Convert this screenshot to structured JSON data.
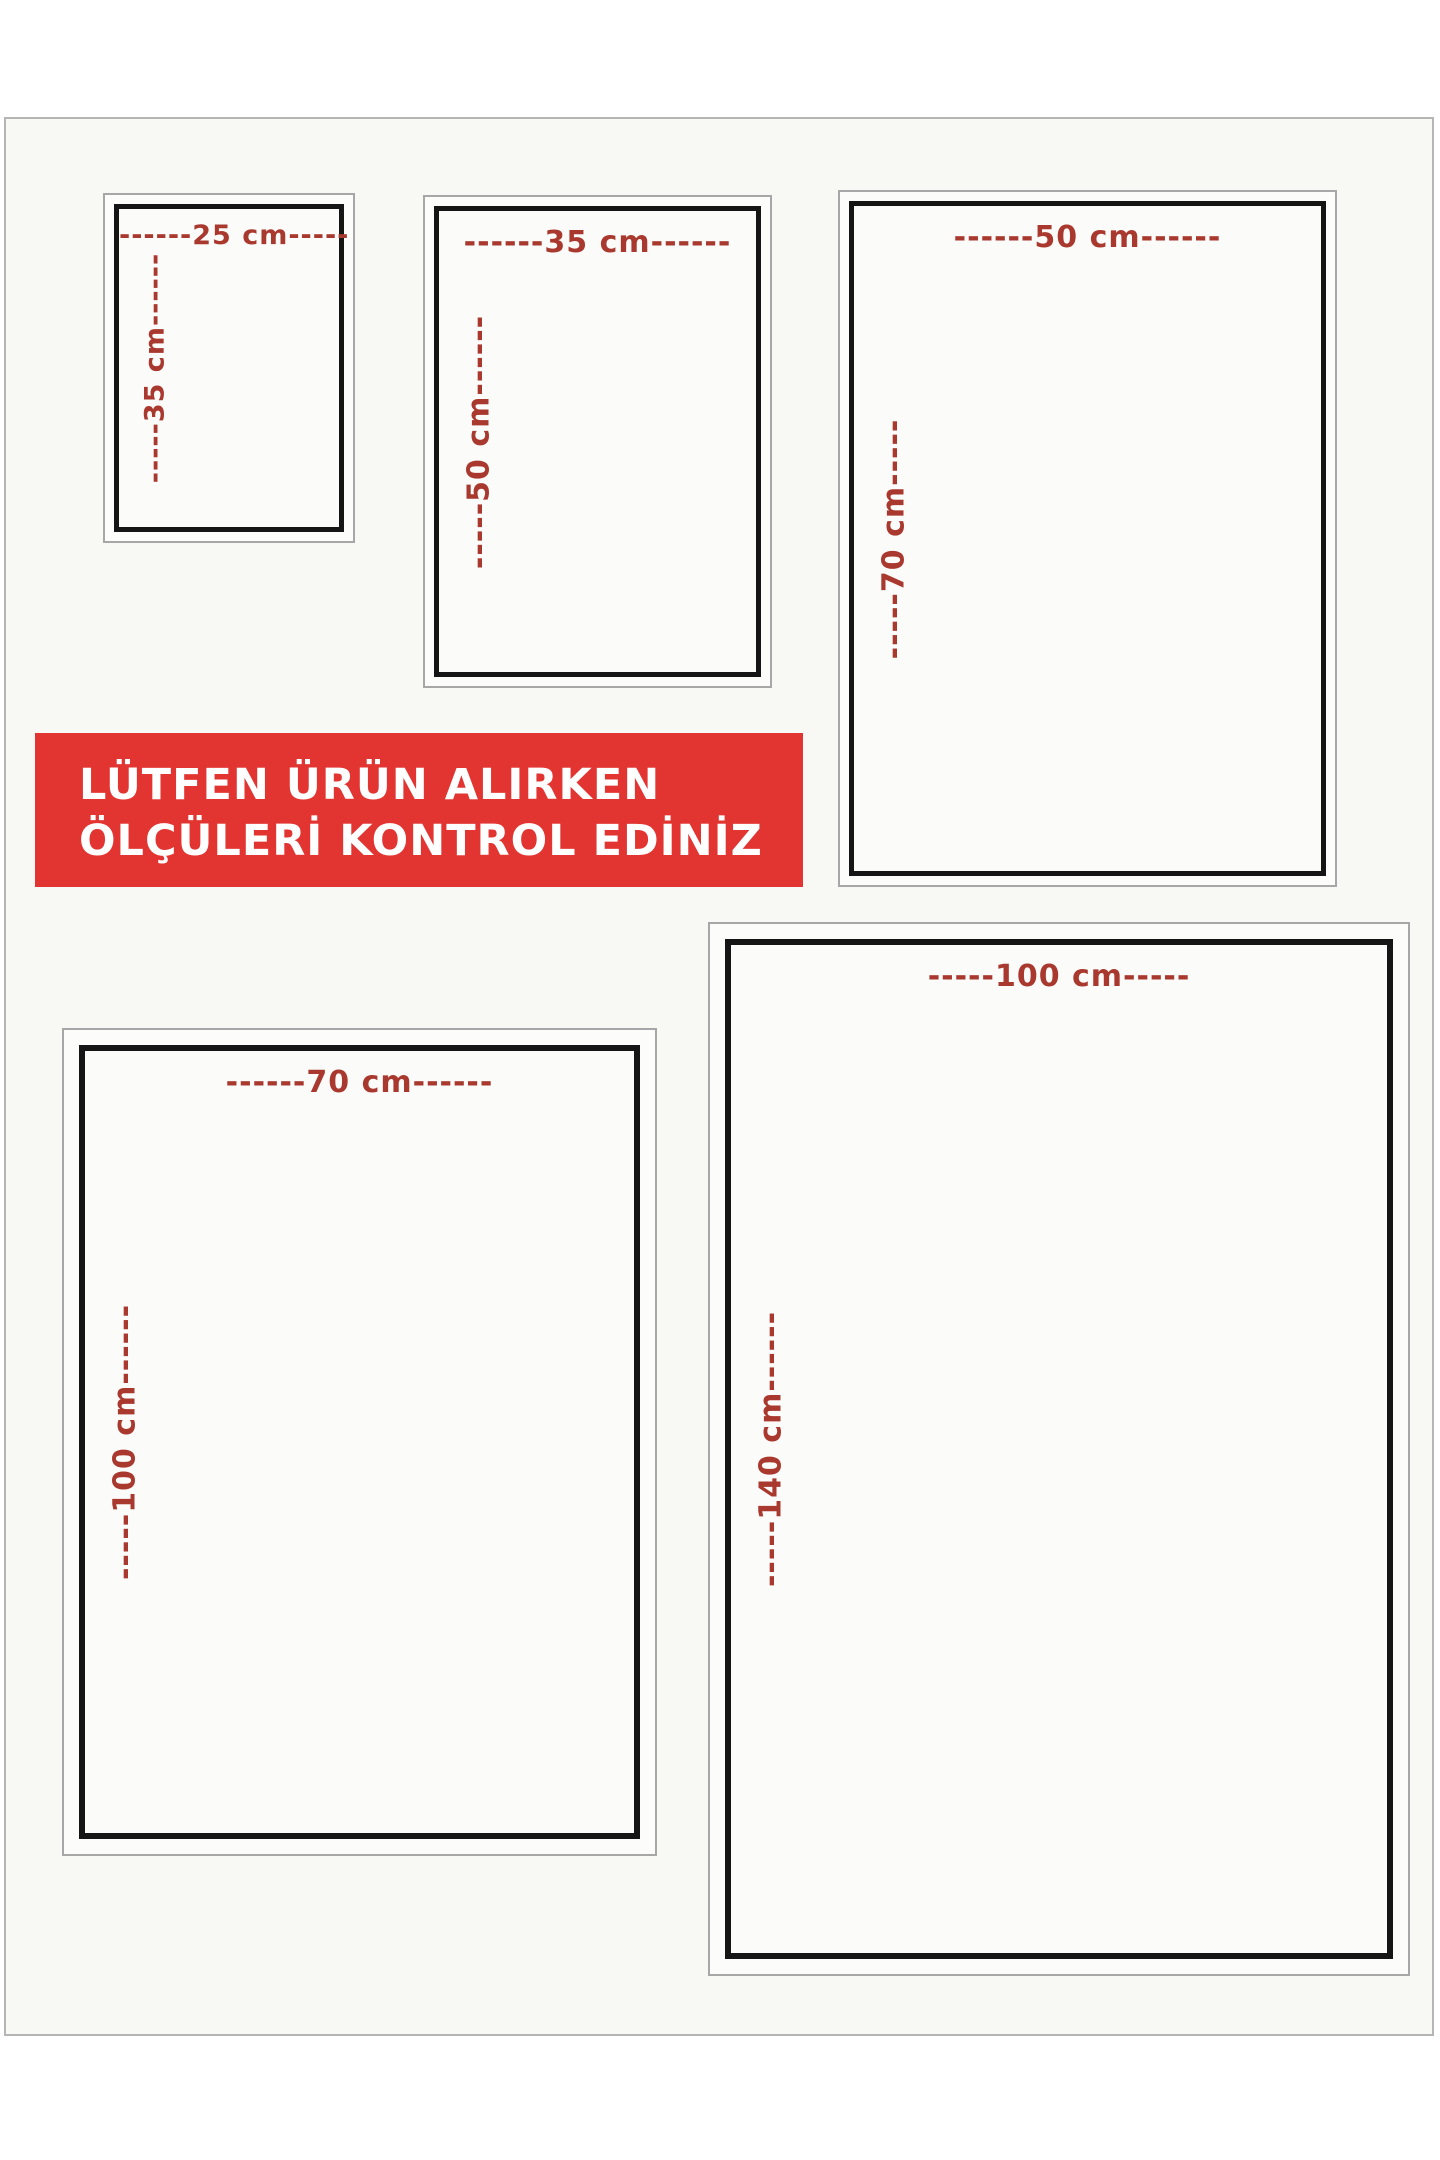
{
  "banner": {
    "line1": "LÜTFEN ÜRÜN ALIRKEN",
    "line2": "ÖLÇÜLERİ KONTROL EDİNİZ",
    "bg_color": "#e23431",
    "text_color": "#ffffff"
  },
  "colors": {
    "dimension_label": "#a9392f",
    "frame_inner": "#151515",
    "frame_outer": "#a7a7a7",
    "canvas_bg": "#f8f8f5",
    "page_bg": "#ffffff"
  },
  "sizes": [
    {
      "name": "25x35",
      "width_cm": 25,
      "height_cm": 35,
      "width_label": "------25 cm-----",
      "height_label": "-----35 cm------"
    },
    {
      "name": "35x50",
      "width_cm": 35,
      "height_cm": 50,
      "width_label": "------35 cm------",
      "height_label": "-----50 cm------"
    },
    {
      "name": "50x70",
      "width_cm": 50,
      "height_cm": 70,
      "width_label": "------50 cm------",
      "height_label": "-----70 cm-----"
    },
    {
      "name": "70x100",
      "width_cm": 70,
      "height_cm": 100,
      "width_label": "------70 cm------",
      "height_label": "-----100 cm------"
    },
    {
      "name": "100x140",
      "width_cm": 100,
      "height_cm": 140,
      "width_label": "-----100 cm-----",
      "height_label": "-----140 cm------"
    }
  ]
}
